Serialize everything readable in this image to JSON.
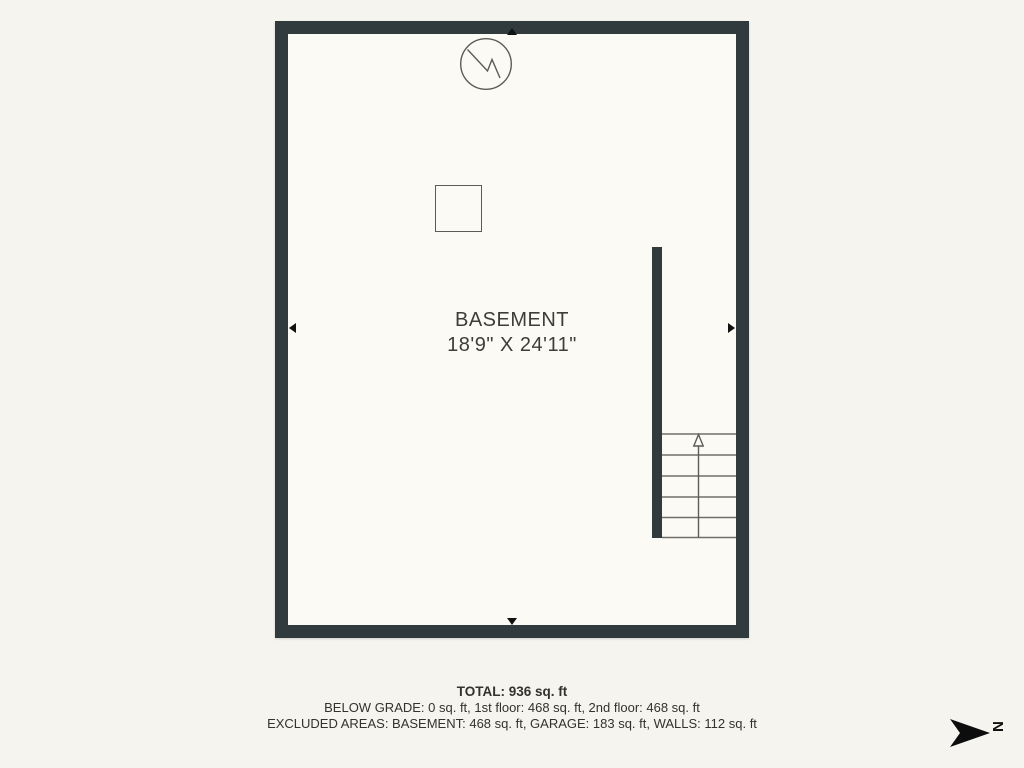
{
  "page": {
    "title": "Basement floor plan"
  },
  "colors": {
    "page_background": "#f5f4ee",
    "floor_background": "#fbfaf4",
    "wall": "#313a3c",
    "stair_line": "#6f6e68",
    "symbol_stroke": "#5c5b55",
    "text": "#33322e",
    "arrow_black": "#111111"
  },
  "floor_plan": {
    "room_label": "BASEMENT",
    "room_dimensions": "18'9\" X 24'11\"",
    "symbols": [
      "circle-zigzag-utility-symbol",
      "square-column-symbol",
      "staircase-with-up-arrow",
      "dimension-arrows-on-walls"
    ]
  },
  "summary": {
    "total": "TOTAL: 936 sq. ft",
    "below_grade": "BELOW GRADE: 0 sq. ft, 1st floor: 468 sq. ft, 2nd floor: 468 sq. ft",
    "excluded_areas": "EXCLUDED AREAS: BASEMENT: 468 sq. ft, GARAGE: 183 sq. ft, WALLS: 112 sq. ft"
  },
  "compass": {
    "label": "N"
  }
}
